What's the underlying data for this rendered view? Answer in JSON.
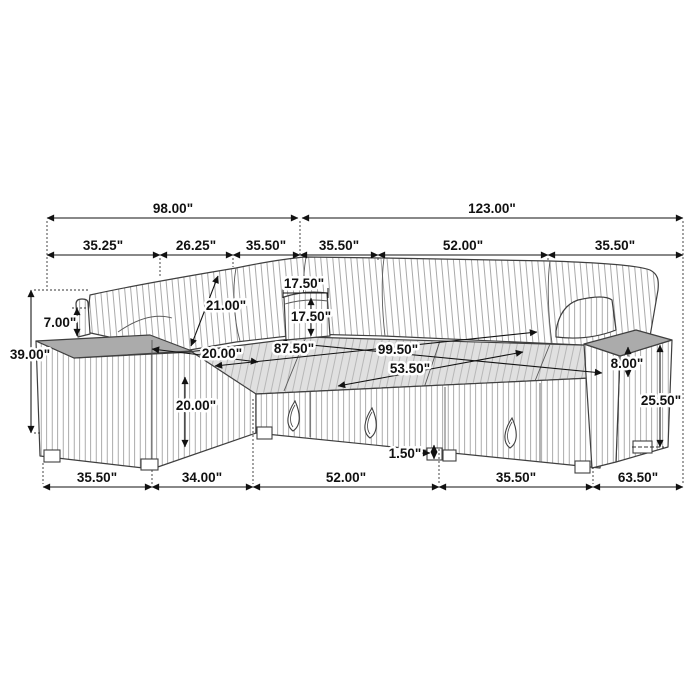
{
  "diagram": {
    "type": "furniture-dimension-drawing",
    "subject": "U-shaped sectional sleeper sofa with chaise and storage",
    "unit": "inches"
  },
  "measurements": {
    "overall_left": "98.00\"",
    "overall_right": "123.00\"",
    "top_seg_1": "35.25\"",
    "top_seg_2": "26.25\"",
    "top_seg_3": "35.50\"",
    "top_seg_4": "35.50\"",
    "top_seg_5": "52.00\"",
    "top_seg_6": "35.50\"",
    "overall_height": "39.00\"",
    "back_cushion_above_arm": "7.00\"",
    "backrest_height": "21.00\"",
    "pillow_width": "17.50\"",
    "pillow_height": "17.50\"",
    "armrest_depth": "20.00\"",
    "seat_front_height": "20.00\"",
    "bed_width_inner": "87.50\"",
    "bed_width_outer": "99.50\"",
    "bed_depth": "53.50\"",
    "leg_height": "1.50\"",
    "arm_above_seat": "8.00\"",
    "arm_height": "25.50\"",
    "bottom_seg_1": "35.50\"",
    "bottom_seg_2": "34.00\"",
    "bottom_seg_3": "52.00\"",
    "bottom_seg_4": "35.50\"",
    "bottom_seg_5": "63.50\""
  },
  "colors": {
    "background": "#ffffff",
    "line_art": "#3f3f3f",
    "dimension_lines": "#111111",
    "arm_top_gray": "#ababab",
    "deck_gray": "#e0e0e0",
    "stripe_gray": "#909090"
  }
}
